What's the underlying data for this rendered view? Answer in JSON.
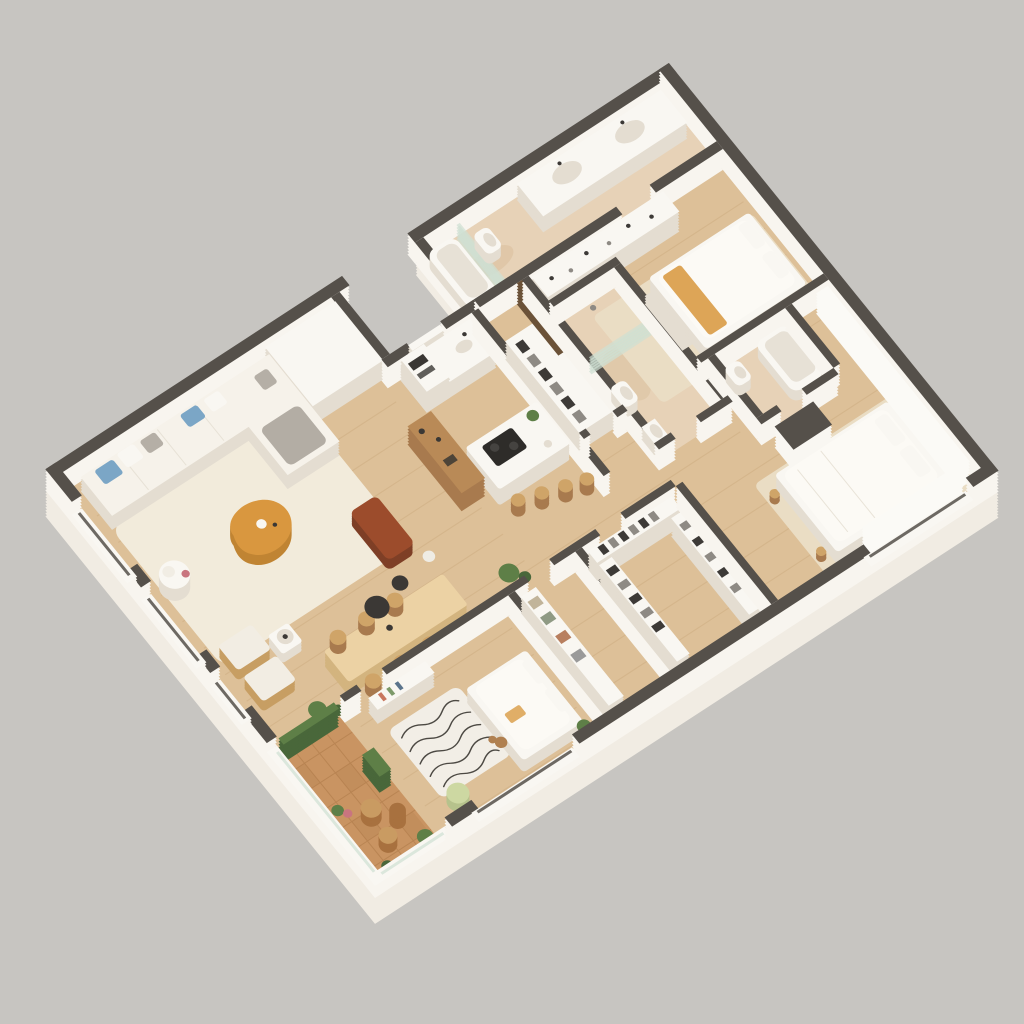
{
  "scene": {
    "type": "isometric-3d-floor-plan-render",
    "background": "plain warm gray, no text, no UI elements",
    "view": "cutaway walls seen from above at an angle"
  },
  "palette": {
    "bg": "#c7c5c1",
    "wallTop": "#55504a",
    "wallSide": "#f8f5ef",
    "slab": "#f1ece3",
    "wood": "#ddc098",
    "woodLine": "#c9a578",
    "trav": "#e7d2b7",
    "travSpot": "#d8bb97",
    "rugCream": "#f2ebdb",
    "rugBeige": "#eaddc4",
    "balc": "#c99462",
    "balcLine": "#b07c4c",
    "zebraBg": "#f2eee6",
    "zebraDark": "#3a3631",
    "white": "#f9f7f2",
    "furnSide": "#e4ddd1",
    "sofaTop": "#f6f2ea",
    "pillowBlue": "#7ba6c6",
    "pillowGray": "#b5afa6",
    "blanket": "#b3ada4",
    "tableOrange": "#d9973f",
    "tableOrangeSide": "#c08433",
    "rust": "#9c4c2c",
    "rustSide": "#7e3f26",
    "dineTop": "#ecd2a4",
    "dineSide": "#d3b47f",
    "stool": "#cfa468",
    "chairFabric": "#f2ede3",
    "chairWood": "#c79e63",
    "barWood": "#b98a57",
    "barWoodSide": "#a87a4e",
    "pendant": "#3b3835",
    "cooktop": "#2e2c29",
    "green": "#5e7f47",
    "greenDark": "#49673a",
    "pot": "#a8784f",
    "rattan": "#c99b62",
    "rattanDark": "#a8713f",
    "clothesDark": "#3d3a37",
    "clothesLight": "#8e8a84",
    "glass": "#cfe0d3",
    "curtain": "#fbfaf6",
    "duvet": "#fcfaf5",
    "teddy": "#b08050",
    "pouf": "#cdd8a2",
    "accentOrange": "#dba04e",
    "slatWood": "#6b5238",
    "oven": "#3a3733",
    "flowerPink": "#c9757f"
  },
  "apartment": {
    "counts": {
      "bedrooms": 3,
      "bathrooms": 3,
      "balconies": 1
    },
    "rooms": [
      {
        "name": "living-dining-room",
        "features": [
          "l-shaped-white-sofa",
          "blue-and-gray-cushions",
          "gray-throw-blanket",
          "cream-shag-rug",
          "organic-orange-coffee-table",
          "side-table-with-lamp",
          "two-wood-armchairs",
          "rust-lounge-chair",
          "wood-dining-table",
          "six-chairs",
          "two-black-pendant-lamps",
          "wood-bar-cabinet",
          "potted-plants"
        ]
      },
      {
        "name": "kitchen",
        "features": [
          "white-back-counter",
          "tall-oven-cabinet",
          "sink-with-faucet",
          "white-island",
          "black-cooktop",
          "four-bar-stools",
          "plant"
        ]
      },
      {
        "name": "entry-hall",
        "features": [
          "recessed-entrance-notch",
          "front-door",
          "built-in-wardrobe"
        ]
      },
      {
        "name": "family-bathroom",
        "features": [
          "bathtub",
          "toilet",
          "glass-partition",
          "double-sink-vanity",
          "travertine-floor"
        ]
      },
      {
        "name": "bedroom-2",
        "features": [
          "double-bed-white",
          "orange-throw",
          "beige-rug",
          "wardrobe-row",
          "open-clothes-rack",
          "dark-slat-partition",
          "bench"
        ]
      },
      {
        "name": "guest-bathroom",
        "features": [
          "walk-in-shower",
          "glass-screen",
          "toilet",
          "sink",
          "travertine-floor"
        ]
      },
      {
        "name": "ensuite-bathroom",
        "features": [
          "toilet",
          "bathtub",
          "travertine-floor"
        ]
      },
      {
        "name": "master-bedroom",
        "features": [
          "double-bed-white",
          "beige-rug",
          "freestanding-wardrobe-dark-top",
          "curtains",
          "stools"
        ]
      },
      {
        "name": "walk-in-closet",
        "features": [
          "clothes-racks-three-sides"
        ]
      },
      {
        "name": "storage-room",
        "features": [
          "shelving-with-boxes"
        ]
      },
      {
        "name": "kids-bedroom",
        "features": [
          "single-bed",
          "zebra-pattern-rug",
          "wall-shelf-with-books",
          "green-pouf",
          "teddy-bear",
          "plant"
        ]
      },
      {
        "name": "corridor",
        "features": []
      },
      {
        "name": "balcony",
        "features": [
          "terracotta-deck-tiles",
          "vertical-garden-panels",
          "rattan-chairs",
          "round-side-table",
          "potted-plants",
          "glass-parapet"
        ]
      }
    ]
  }
}
